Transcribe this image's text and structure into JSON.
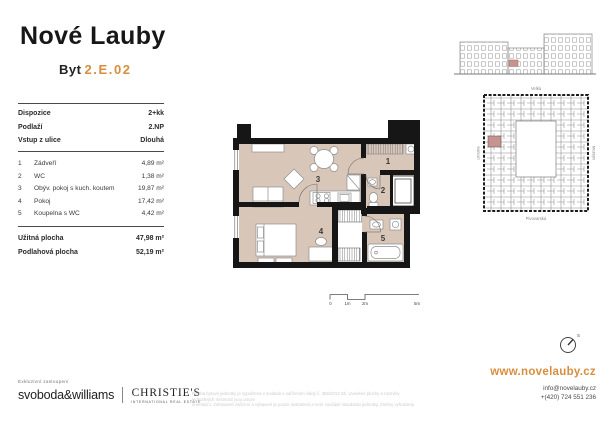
{
  "colors": {
    "accent": "#d78e3e",
    "plan_floor": "#d8c6b9",
    "unit_highlight": "#c6938f",
    "wall": "#161616"
  },
  "header": {
    "logo": "Nové Lauby",
    "unit_label": "Byt",
    "unit_number": "2.E.02"
  },
  "info": {
    "meta": [
      {
        "label": "Dispozice",
        "value": "2+kk"
      },
      {
        "label": "Podlaží",
        "value": "2.NP"
      },
      {
        "label": "Vstup z ulice",
        "value": "Dlouhá"
      }
    ],
    "rooms": [
      {
        "num": "1",
        "name": "Zádveří",
        "area": "4,89 m²"
      },
      {
        "num": "2",
        "name": "WC",
        "area": "1,38 m²"
      },
      {
        "num": "3",
        "name": "Obýv. pokoj s kuch. koutem",
        "area": "19,87 m²"
      },
      {
        "num": "4",
        "name": "Pokoj",
        "area": "17,42 m²"
      },
      {
        "num": "5",
        "name": "Koupelna s WC",
        "area": "4,42 m²"
      }
    ],
    "totals": [
      {
        "label": "Užitná plocha",
        "value": "47,98 m²"
      },
      {
        "label": "Podlahová plocha",
        "value": "52,19 m²"
      }
    ]
  },
  "floorplan": {
    "room_labels": [
      "1",
      "2",
      "3",
      "4",
      "5"
    ],
    "scale_ticks": [
      "0",
      "1m",
      "2m",
      "5m"
    ]
  },
  "siteplan": {
    "streets": {
      "top": "Velká",
      "left": "Dlouhá",
      "right": "Muzejní",
      "bottom": "Pivovarská"
    },
    "compass_label": "S"
  },
  "footer": {
    "exclusive": "Exkluzivní zastoupení",
    "agency1": "svoboda&williams",
    "agency2": "CHRISTIE'S",
    "agency2_sub": "INTERNATIONAL REAL ESTATE",
    "disclaimer_line1": "Plocha bytové jednotky je vypočtena v souladu s nařízením vlády č. 366/2013 Sb. Uvedené plochy a rozměry jednotlivých místností jsou pouze",
    "disclaimer_line2": "orientační. Zobrazené zařízení a vybavení je pouze ilustrativní a není součástí standardu jednotky. Změny vyhrazeny.",
    "website": "www.novelauby.cz",
    "email": "info@novelauby.cz",
    "phone": "+(420) 724 551 236"
  }
}
